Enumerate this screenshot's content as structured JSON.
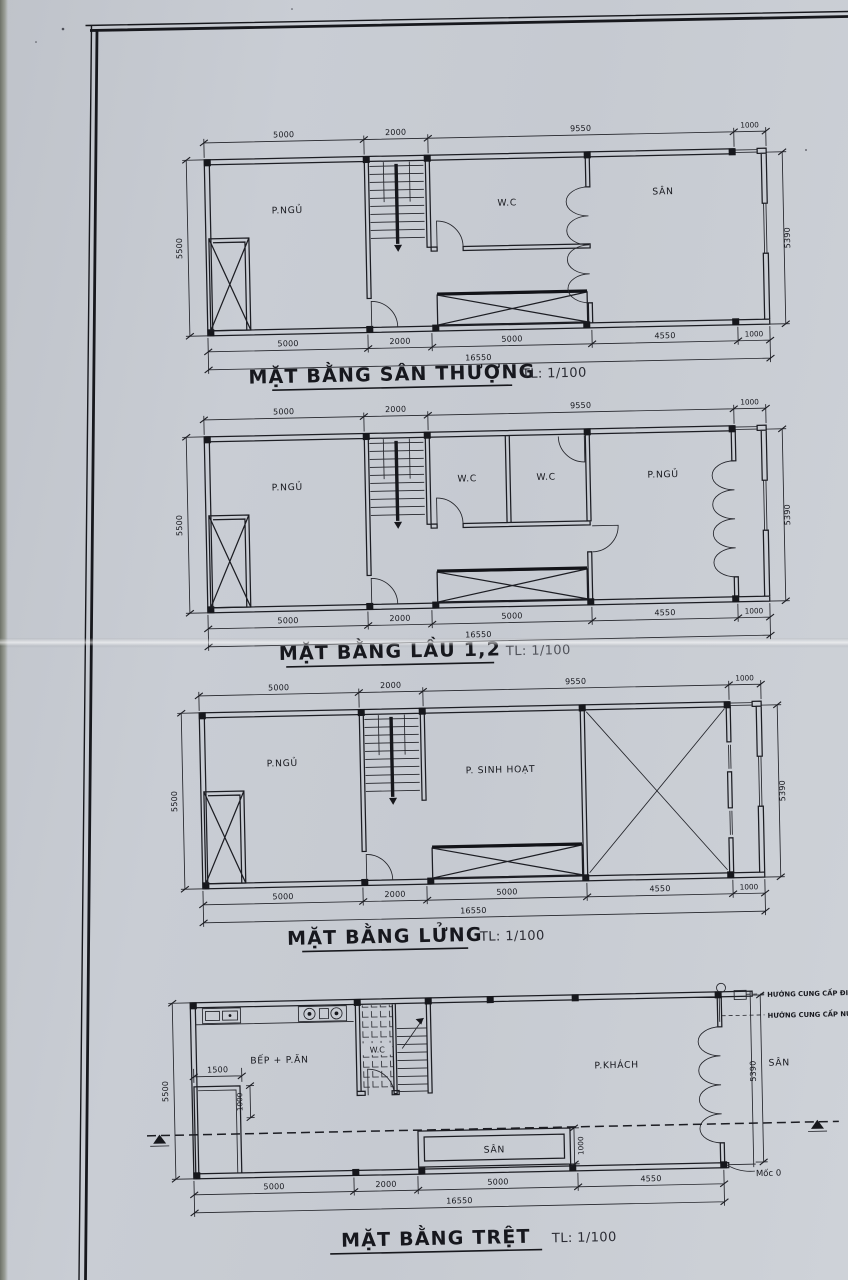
{
  "sheet": {
    "plans": [
      {
        "id": "san-thuong",
        "title": "MẶT BẰNG SÂN THƯỢNG",
        "scale": "TL: 1/100",
        "rooms": {
          "bedroom": "P.NGỦ",
          "wc": "W.C",
          "terrace": "SÂN"
        },
        "dims": {
          "top": [
            "5000",
            "2000",
            "9550",
            "1000"
          ],
          "left": "5500",
          "right": "5390",
          "bottom": [
            "5000",
            "2000",
            "5000",
            "4550",
            "1000"
          ],
          "total": "16550"
        }
      },
      {
        "id": "lau-1-2",
        "title": "MẶT BẰNG LẦU 1,2",
        "scale": "TL: 1/100",
        "rooms": {
          "bedroom_left": "P.NGỦ",
          "wc_left": "W.C",
          "wc_right": "W.C",
          "bedroom_right": "P.NGỦ"
        },
        "dims": {
          "top": [
            "5000",
            "2000",
            "9550",
            "1000"
          ],
          "left": "5500",
          "right": "5390",
          "bottom": [
            "5000",
            "2000",
            "5000",
            "4550",
            "1000"
          ],
          "total": "16550"
        }
      },
      {
        "id": "lung",
        "title": "MẶT BẰNG LỬNG",
        "scale": "TL: 1/100",
        "rooms": {
          "bedroom": "P.NGỦ",
          "living": "P. SINH HOẠT"
        },
        "dims": {
          "top": [
            "5000",
            "2000",
            "9550",
            "1000"
          ],
          "left": "5500",
          "right": "5390",
          "bottom": [
            "5000",
            "2000",
            "5000",
            "4550",
            "1000"
          ],
          "total": "16550"
        }
      },
      {
        "id": "tret",
        "title": "MẶT BẰNG TRỆT",
        "scale": "TL: 1/100",
        "rooms": {
          "kitchen_dining": "BẾP + P.ĂN",
          "wc": "W.C",
          "living": "P.KHÁCH",
          "yard": "SÂN",
          "side_yard": "SÂN"
        },
        "dims": {
          "left": "5500",
          "right": "5390",
          "bottom": [
            "5000",
            "2000",
            "5000",
            "4550"
          ],
          "total": "16550",
          "closet_width": "1500",
          "closet_depth": "1000",
          "yard_depth": "1000"
        },
        "annotations": {
          "power": "HƯỚNG CUNG CẤP ĐIỆN",
          "water": "HƯỚNG CUNG CẤP NƯỚC",
          "datum": "Mốc 0"
        }
      }
    ]
  }
}
